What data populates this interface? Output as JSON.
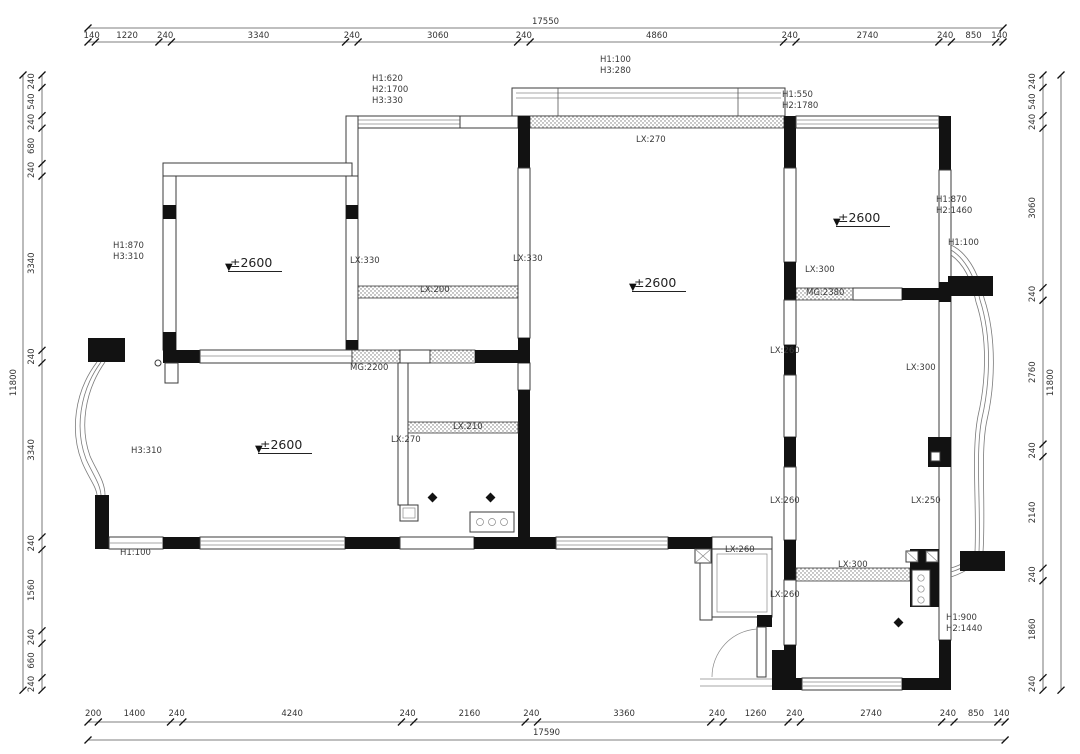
{
  "level_text": "±2600",
  "level_symbol": "▼",
  "colors": {
    "wall": "#3b3b3b",
    "black_fill": "#121212",
    "dim_line": "#555555",
    "text": "#333333"
  },
  "dimensions": {
    "top": {
      "total": "17550",
      "segments": [
        "140",
        "1220",
        "240",
        "3340",
        "240",
        "3060",
        "240",
        "4860",
        "240",
        "2740",
        "240",
        "850",
        "140"
      ]
    },
    "bottom": {
      "total": "17590",
      "segments": [
        "200",
        "1400",
        "240",
        "4240",
        "240",
        "2160",
        "240",
        "3360",
        "240",
        "1260",
        "240",
        "2740",
        "240",
        "850",
        "140"
      ]
    },
    "left": {
      "total": "11800",
      "segments": [
        "240",
        "540",
        "240",
        "680",
        "240",
        "3340",
        "240",
        "3340",
        "240",
        "1560",
        "240",
        "660",
        "240"
      ]
    },
    "right": {
      "total": "11800",
      "segments": [
        "240",
        "540",
        "240",
        "3060",
        "240",
        "2760",
        "240",
        "2140",
        "240",
        "1860",
        "240"
      ]
    }
  },
  "annotations": [
    {
      "text": "H1:620\nH2:1700\nH3:330",
      "x": 372,
      "y": 74
    },
    {
      "text": "H1:100\nH3:280",
      "x": 600,
      "y": 55
    },
    {
      "text": "H1:550\nH2:1780",
      "x": 782,
      "y": 90
    },
    {
      "text": "LX:270",
      "x": 636,
      "y": 135
    },
    {
      "text": "H1:870\nH3:310",
      "x": 113,
      "y": 241
    },
    {
      "text": "LX:330",
      "x": 350,
      "y": 256
    },
    {
      "text": "LX:330",
      "x": 513,
      "y": 254
    },
    {
      "text": "LX:200",
      "x": 420,
      "y": 285
    },
    {
      "text": "LX:300",
      "x": 805,
      "y": 265
    },
    {
      "text": "MG:2380",
      "x": 806,
      "y": 288
    },
    {
      "text": "H1:870\nH2:1460",
      "x": 936,
      "y": 195
    },
    {
      "text": "H1:100",
      "x": 948,
      "y": 238
    },
    {
      "text": "MG:2200",
      "x": 350,
      "y": 363
    },
    {
      "text": "LX:260",
      "x": 770,
      "y": 346
    },
    {
      "text": "LX:300",
      "x": 906,
      "y": 363
    },
    {
      "text": "LX:270",
      "x": 391,
      "y": 435
    },
    {
      "text": "LX:210",
      "x": 453,
      "y": 422
    },
    {
      "text": "H3:310",
      "x": 131,
      "y": 446
    },
    {
      "text": "H1:100",
      "x": 120,
      "y": 548
    },
    {
      "text": "LX:260",
      "x": 770,
      "y": 496
    },
    {
      "text": "LX:250",
      "x": 911,
      "y": 496
    },
    {
      "text": "LX:260",
      "x": 725,
      "y": 545
    },
    {
      "text": "LX:300",
      "x": 838,
      "y": 560
    },
    {
      "text": "LX:260",
      "x": 770,
      "y": 590
    },
    {
      "text": "H1:900\nH2:1440",
      "x": 946,
      "y": 613
    }
  ],
  "level_markers": [
    {
      "x": 228,
      "y": 252
    },
    {
      "x": 632,
      "y": 272
    },
    {
      "x": 836,
      "y": 207
    },
    {
      "x": 258,
      "y": 434
    }
  ]
}
